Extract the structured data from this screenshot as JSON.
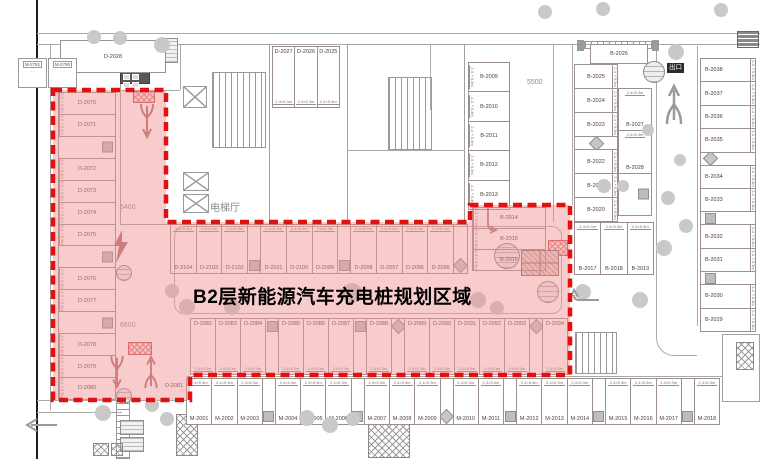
{
  "title": "B2层新能源汽车充电桩规划区域",
  "signs": {
    "exit": "出口",
    "elevator_hall": "电梯厅"
  },
  "dims": {
    "stall": "2.4×5.3m",
    "aisle_left": "5400",
    "aisle_left_lower": "6600",
    "aisle_right": "5500"
  },
  "singles": {
    "top_left": "D-2028",
    "corner": "D-2081",
    "col_a_top": "B-2026"
  },
  "rooms": {
    "small_1": "M-2781",
    "small_2": "M-2780",
    "small_1_sub": "····",
    "small_2_sub": "····"
  },
  "colors": {
    "highlight_fill": "#f19393",
    "highlight_border": "#e2100e",
    "linework": "#9e8f8f"
  },
  "groups": {
    "left_column": {
      "cells": [
        "D-2070",
        "D-2071",
        "",
        "D-2072",
        "D-2073",
        "D-2074",
        "D-2075",
        "",
        "D-2076",
        "D-2077",
        "",
        "D-2078",
        "D-2079",
        "D-2080"
      ]
    },
    "top_mid": {
      "cells": [
        "D-2027",
        "D-2026",
        "D-2025"
      ]
    },
    "inner_right": {
      "cells": [
        "B-2009",
        "B-2010",
        "B-2011",
        "B-2012",
        "B-2013"
      ]
    },
    "mid_row": {
      "cells": [
        "D-2104",
        "D-2103",
        "D-2102",
        "#box",
        "D-2101",
        "D-2100",
        "D-2099",
        "#box",
        "D-2098",
        "D-2097",
        "D-2096",
        "D-2095",
        "#dia"
      ]
    },
    "ext_right": {
      "cells": [
        "B-2014",
        "B-2015",
        "B-2016"
      ]
    },
    "bottom_row": {
      "cells": [
        "D-2082",
        "D-2083",
        "D-2084",
        "#box",
        "D-2085",
        "D-2086",
        "D-2087",
        "#box",
        "D-2088",
        "#dia",
        "D-2089",
        "D-2090",
        "D-2091",
        "D-2092",
        "D-2093",
        "#dia",
        "D-2094"
      ]
    },
    "m_row": {
      "cells": [
        "M-2001",
        "M-2002",
        "M-2003",
        "#box",
        "M-2004",
        "M-2005",
        "M-2006",
        "#box",
        "M-2007",
        "M-2008",
        "M-2009",
        "#dia",
        "M-2010",
        "M-2011",
        "#box",
        "M-2012",
        "M-2013",
        "M-2014",
        "#box",
        "M-2015",
        "M-2016",
        "M-2017",
        "#box",
        "M-2018"
      ]
    },
    "b1719_row": {
      "cells": [
        "B-2017",
        "B-2018",
        "B-2019"
      ]
    },
    "col_a": {
      "cells": [
        "B-2025",
        "B-2024",
        "B-2023",
        "#dia",
        "B-2022",
        "B-2021",
        "B-2020"
      ]
    },
    "col_a2": {
      "cells": [
        "B-2027",
        "B-2028",
        ""
      ]
    },
    "col_b": {
      "cells": [
        "B-2038",
        "B-2037",
        "B-2036",
        "B-2035",
        "#dia",
        "B-2034",
        "B-2033",
        "#box",
        "B-2032",
        "B-2031",
        "#box",
        "B-2030",
        "B-2029"
      ]
    }
  }
}
